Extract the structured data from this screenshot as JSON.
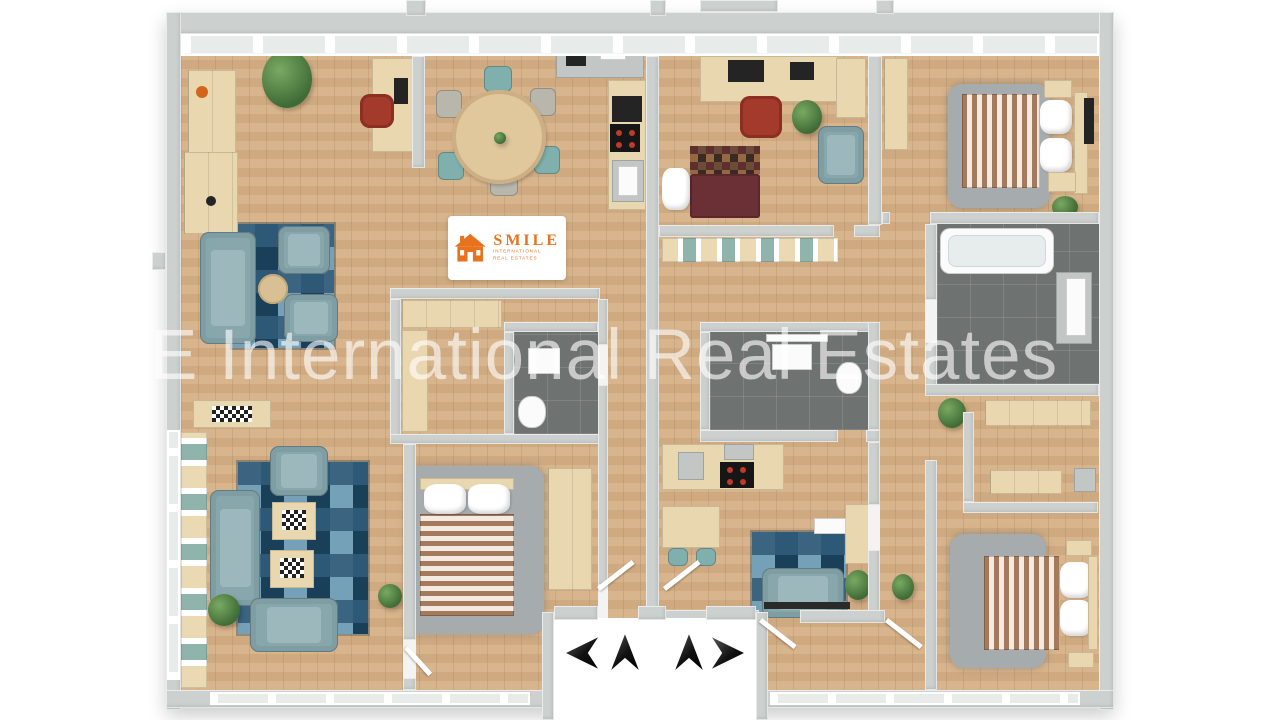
{
  "watermark": {
    "text": "E International Real Estates"
  },
  "logo": {
    "name": "SMILE",
    "line1": "INTERNATIONAL",
    "line2": "REAL ESTATES",
    "accent_color": "#E8731F"
  },
  "navigation": {
    "arrows": [
      {
        "icon": "arrow-left",
        "direction": "left"
      },
      {
        "icon": "arrow-up",
        "direction": "up"
      },
      {
        "icon": "arrow-up",
        "direction": "up"
      },
      {
        "icon": "arrow-right",
        "direction": "right"
      }
    ]
  },
  "palette": {
    "floor_wood": "#d6b085",
    "wall_gray": "#ccd0ce",
    "tile_dark": "#6e7270",
    "rug_blue": "#2d5977",
    "sofa_blue_gray": "#87a7ad",
    "bed_stripe": "#a57a5c",
    "accent_orange": "#e8731f"
  }
}
